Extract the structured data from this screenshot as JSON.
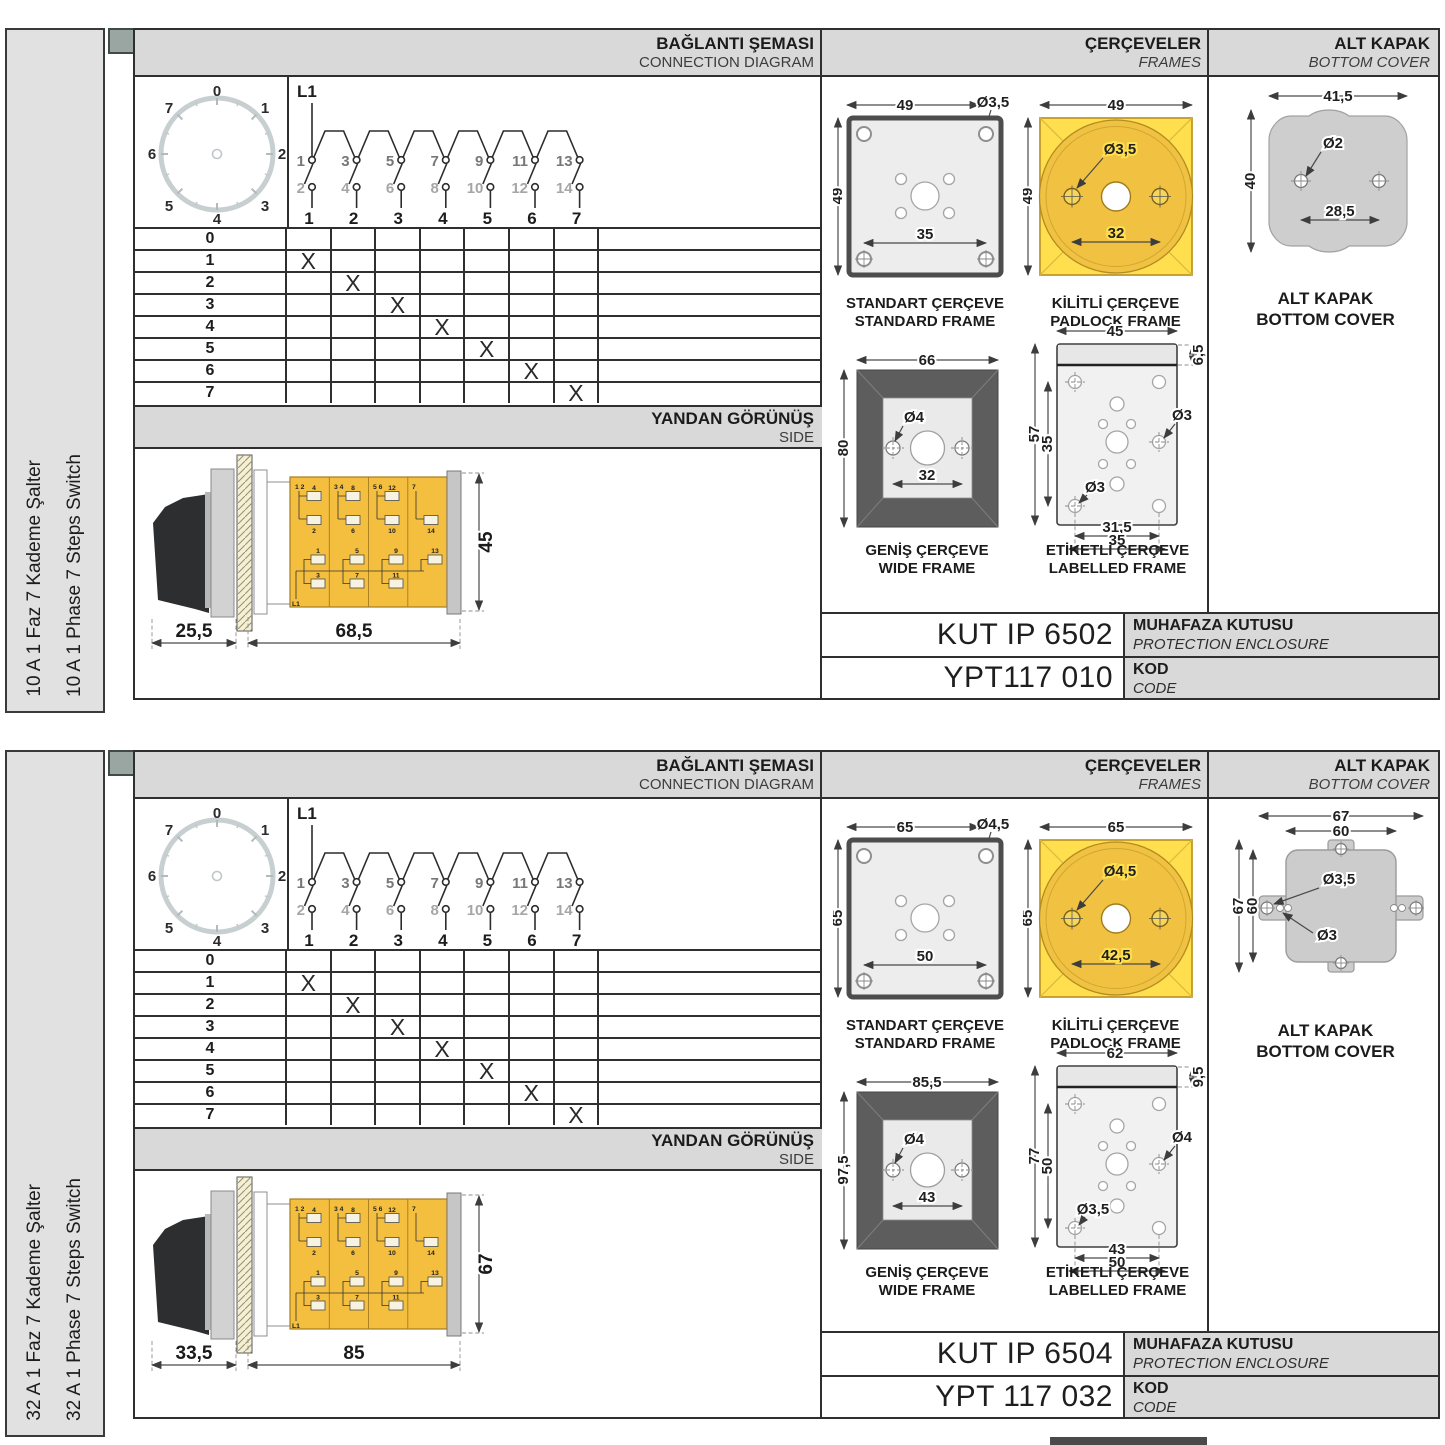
{
  "sections": [
    {
      "strip": {
        "line1": "10 A 1 Faz 7 Kademe Şalter",
        "line2": "10 A 1 Phase 7 Steps Switch"
      },
      "headers": {
        "diagram_tr": "BAĞLANTI ŞEMASI",
        "diagram_en": "CONNECTION DIAGRAM",
        "frames_tr": "ÇERÇEVELER",
        "frames_en": "FRAMES",
        "cover_tr": "ALT KAPAK",
        "cover_en": "BOTTOM COVER",
        "side_tr": "YANDAN GÖRÜNÜŞ",
        "side_en": "SIDE"
      },
      "dial": {
        "labels": [
          "0",
          "1",
          "2",
          "3",
          "4",
          "5",
          "6",
          "7"
        ]
      },
      "diagram": {
        "feed": "L1",
        "top_contacts": [
          "1",
          "3",
          "5",
          "7",
          "9",
          "11",
          "13"
        ],
        "bottom_contacts": [
          "2",
          "4",
          "6",
          "8",
          "10",
          "12",
          "14"
        ],
        "columns": [
          "1",
          "2",
          "3",
          "4",
          "5",
          "6",
          "7"
        ]
      },
      "table": {
        "rows": [
          {
            "label": "0",
            "cells": [
              "",
              "",
              "",
              "",
              "",
              "",
              ""
            ]
          },
          {
            "label": "1",
            "cells": [
              "X",
              "",
              "",
              "",
              "",
              "",
              ""
            ]
          },
          {
            "label": "2",
            "cells": [
              "",
              "X",
              "",
              "",
              "",
              "",
              ""
            ]
          },
          {
            "label": "3",
            "cells": [
              "",
              "",
              "X",
              "",
              "",
              "",
              ""
            ]
          },
          {
            "label": "4",
            "cells": [
              "",
              "",
              "",
              "X",
              "",
              "",
              ""
            ]
          },
          {
            "label": "5",
            "cells": [
              "",
              "",
              "",
              "",
              "X",
              "",
              ""
            ]
          },
          {
            "label": "6",
            "cells": [
              "",
              "",
              "",
              "",
              "",
              "X",
              ""
            ]
          },
          {
            "label": "7",
            "cells": [
              "",
              "",
              "",
              "",
              "",
              "",
              "X"
            ]
          }
        ]
      },
      "side": {
        "dim_front": "25,5",
        "dim_body": "68,5",
        "dim_height": "45",
        "feed": "L1",
        "modules": [
          {
            "head": "1 2",
            "t1": "4",
            "t2": "2",
            "b1": "1",
            "b2": "3"
          },
          {
            "head": "3 4",
            "t1": "8",
            "t2": "6",
            "b1": "5",
            "b2": "7"
          },
          {
            "head": "5 6",
            "t1": "12",
            "t2": "10",
            "b1": "9",
            "b2": "11"
          },
          {
            "head": "7",
            "t1": "",
            "t2": "14",
            "b1": "13",
            "b2": ""
          }
        ]
      },
      "frames": {
        "standard": {
          "tr": "STANDART ÇERÇEVE",
          "en": "STANDARD FRAME",
          "w": "49",
          "h": "49",
          "hole": "Ø3,5",
          "pitch": "35"
        },
        "padlock": {
          "tr": "KİLİTLİ ÇERÇEVE",
          "en": "PADLOCK FRAME",
          "w": "49",
          "h": "49",
          "hole": "Ø3,5",
          "pitch": "32"
        },
        "wide": {
          "tr": "GENİŞ ÇERÇEVE",
          "en": "WIDE FRAME",
          "w": "66",
          "h": "80",
          "hole": "Ø4",
          "pitch": "32"
        },
        "labelled": {
          "tr": "ETİKETLİ ÇERÇEVE",
          "en": "LABELLED FRAME",
          "w": "45",
          "band": "6,5",
          "h": "57",
          "pitch_v": "35",
          "hole_a": "Ø3",
          "hole_b": "Ø3",
          "pitch_h1": "31,5",
          "pitch_h2": "35"
        }
      },
      "cover": {
        "tr": "ALT KAPAK",
        "en": "BOTTOM COVER",
        "w": "41,5",
        "h": "40",
        "hole": "Ø2",
        "pitch": "28,5"
      },
      "codes": {
        "enclosure": "KUT IP 6502",
        "enc_tr": "MUHAFAZA KUTUSU",
        "enc_en": "PROTECTION ENCLOSURE",
        "code": "YPT117 010",
        "kod_tr": "KOD",
        "kod_en": "CODE"
      }
    },
    {
      "strip": {
        "line1": "32 A 1 Faz 7 Kademe Şalter",
        "line2": "32 A 1 Phase 7 Steps Switch"
      },
      "headers": {
        "diagram_tr": "BAĞLANTI ŞEMASI",
        "diagram_en": "CONNECTION DIAGRAM",
        "frames_tr": "ÇERÇEVELER",
        "frames_en": "FRAMES",
        "cover_tr": "ALT KAPAK",
        "cover_en": "BOTTOM COVER",
        "side_tr": "YANDAN GÖRÜNÜŞ",
        "side_en": "SIDE"
      },
      "dial": {
        "labels": [
          "0",
          "1",
          "2",
          "3",
          "4",
          "5",
          "6",
          "7"
        ]
      },
      "diagram": {
        "feed": "L1",
        "top_contacts": [
          "1",
          "3",
          "5",
          "7",
          "9",
          "11",
          "13"
        ],
        "bottom_contacts": [
          "2",
          "4",
          "6",
          "8",
          "10",
          "12",
          "14"
        ],
        "columns": [
          "1",
          "2",
          "3",
          "4",
          "5",
          "6",
          "7"
        ]
      },
      "table": {
        "rows": [
          {
            "label": "0",
            "cells": [
              "",
              "",
              "",
              "",
              "",
              "",
              ""
            ]
          },
          {
            "label": "1",
            "cells": [
              "X",
              "",
              "",
              "",
              "",
              "",
              ""
            ]
          },
          {
            "label": "2",
            "cells": [
              "",
              "X",
              "",
              "",
              "",
              "",
              ""
            ]
          },
          {
            "label": "3",
            "cells": [
              "",
              "",
              "X",
              "",
              "",
              "",
              ""
            ]
          },
          {
            "label": "4",
            "cells": [
              "",
              "",
              "",
              "X",
              "",
              "",
              ""
            ]
          },
          {
            "label": "5",
            "cells": [
              "",
              "",
              "",
              "",
              "X",
              "",
              ""
            ]
          },
          {
            "label": "6",
            "cells": [
              "",
              "",
              "",
              "",
              "",
              "X",
              ""
            ]
          },
          {
            "label": "7",
            "cells": [
              "",
              "",
              "",
              "",
              "",
              "",
              "X"
            ]
          }
        ]
      },
      "side": {
        "dim_front": "33,5",
        "dim_body": "85",
        "dim_height": "67",
        "feed": "L1",
        "modules": [
          {
            "head": "1 2",
            "t1": "4",
            "t2": "2",
            "b1": "1",
            "b2": "3"
          },
          {
            "head": "3 4",
            "t1": "8",
            "t2": "6",
            "b1": "5",
            "b2": "7"
          },
          {
            "head": "5 6",
            "t1": "12",
            "t2": "10",
            "b1": "9",
            "b2": "11"
          },
          {
            "head": "7",
            "t1": "",
            "t2": "14",
            "b1": "13",
            "b2": ""
          }
        ]
      },
      "frames": {
        "standard": {
          "tr": "STANDART ÇERÇEVE",
          "en": "STANDARD FRAME",
          "w": "65",
          "h": "65",
          "hole": "Ø4,5",
          "pitch": "50"
        },
        "padlock": {
          "tr": "KİLİTLİ ÇERÇEVE",
          "en": "PADLOCK FRAME",
          "w": "65",
          "h": "65",
          "hole": "Ø4,5",
          "pitch": "42,5"
        },
        "wide": {
          "tr": "GENİŞ ÇERÇEVE",
          "en": "WIDE FRAME",
          "w": "85,5",
          "h": "97,5",
          "hole": "Ø4",
          "pitch": "43"
        },
        "labelled": {
          "tr": "ETİKETLİ ÇERÇEVE",
          "en": "LABELLED FRAME",
          "w": "62",
          "band": "9,5",
          "h": "77",
          "pitch_v": "50",
          "hole_a": "Ø4",
          "hole_b": "Ø3,5",
          "pitch_h1": "43",
          "pitch_h2": "50"
        }
      },
      "cover": {
        "tr": "ALT KAPAK",
        "en": "BOTTOM COVER",
        "w": "67",
        "w_in": "60",
        "h": "67",
        "h_in": "60",
        "hole_a": "Ø3,5",
        "hole_b": "Ø3"
      },
      "codes": {
        "enclosure": "KUT IP 6504",
        "enc_tr": "MUHAFAZA KUTUSU",
        "enc_en": "PROTECTION ENCLOSURE",
        "code": "YPT 117 032",
        "kod_tr": "KOD",
        "kod_en": "CODE"
      }
    }
  ]
}
